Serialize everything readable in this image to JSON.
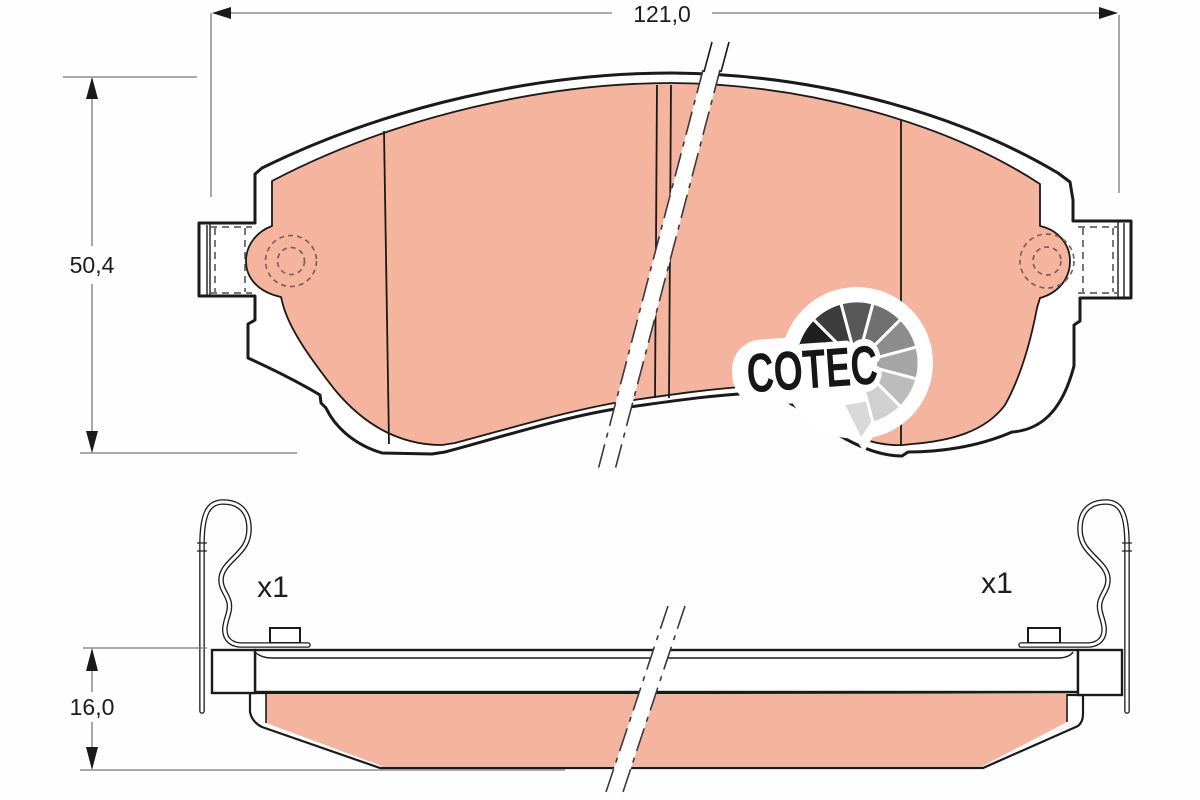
{
  "diagram": {
    "dimensions": {
      "width_label": "121,0",
      "height_label": "50,4",
      "thickness_label": "16,0"
    },
    "quantities": {
      "left_label": "x1",
      "right_label": "x1"
    },
    "logo": {
      "text": "COTEC",
      "fan": [
        "#1f1f1f",
        "#3c3c3c",
        "#575757",
        "#707070",
        "#8d8d8d",
        "#a5a5a5",
        "#bcbcbc",
        "#d0d0d0"
      ],
      "tail": "#d9d9d9"
    },
    "colors": {
      "friction": "#f4b49e",
      "outline": "#1a1a1a",
      "dim_line": "#7a7a7a"
    }
  }
}
